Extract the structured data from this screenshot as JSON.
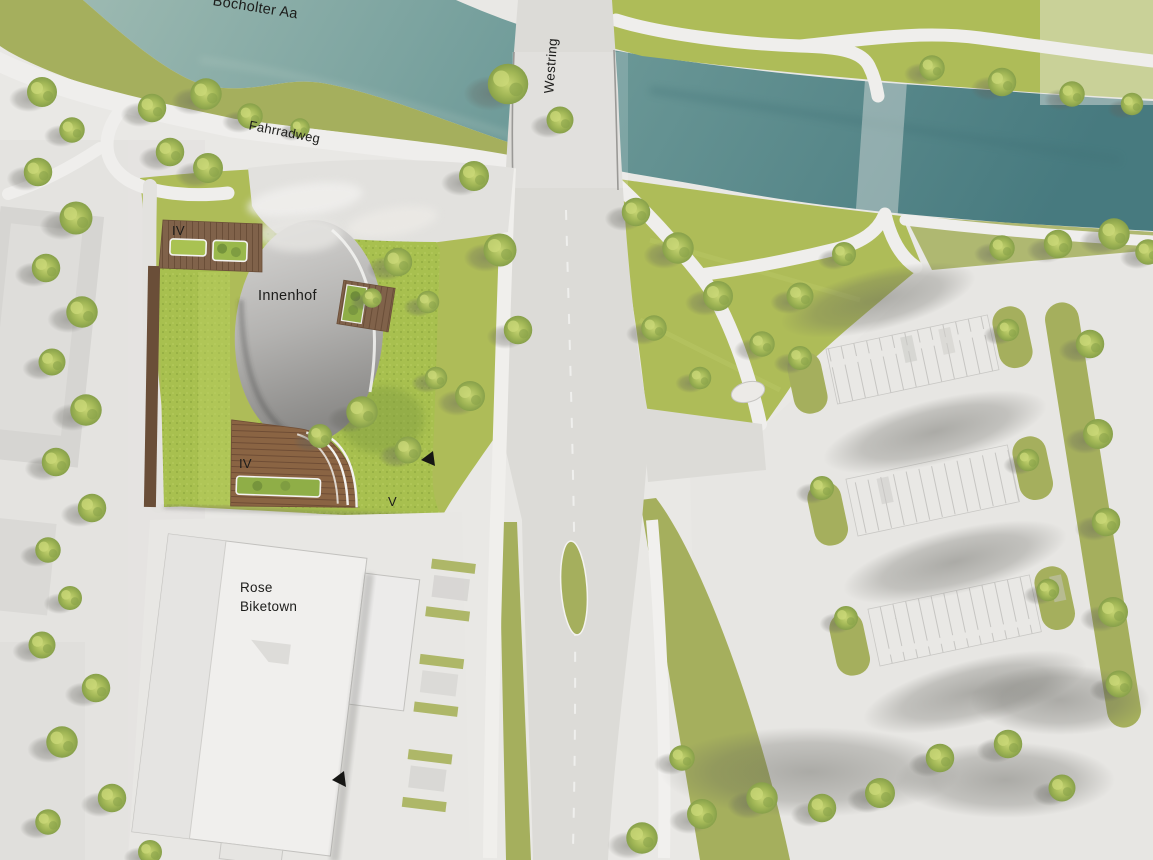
{
  "plan": {
    "labels": {
      "river_name": "Bocholter Aa",
      "street_name": "Westring",
      "bike_path_name": "Fahrradweg",
      "courtyard_name": "Innenhof",
      "floors_block_north": "IV",
      "floors_block_south": "IV",
      "floors_block_v": "V",
      "existing_store_line1": "Rose",
      "existing_store_line2": "Biketown"
    },
    "colors": {
      "water": "#6f9b99",
      "water_light": "#9cb9b1",
      "water_deep": "#477a7f",
      "bank_green": "#a5af5d",
      "lawn_green": "#aebc58",
      "roof_lawn": "#a8c04f",
      "mound_green": "#a0b84f",
      "wood_deck": "#80624a",
      "wood_dark": "#6a4e38",
      "path_light": "#efeeec",
      "road_gray": "#dcdbd7",
      "plaza_gray": "#e2e1de",
      "courtyard_gray": "#a8a7a5",
      "context_gray": "#c9c8c5",
      "island_white": "#eceae7",
      "label_color": "#1c1c1a",
      "marker_black": "#161614"
    }
  }
}
